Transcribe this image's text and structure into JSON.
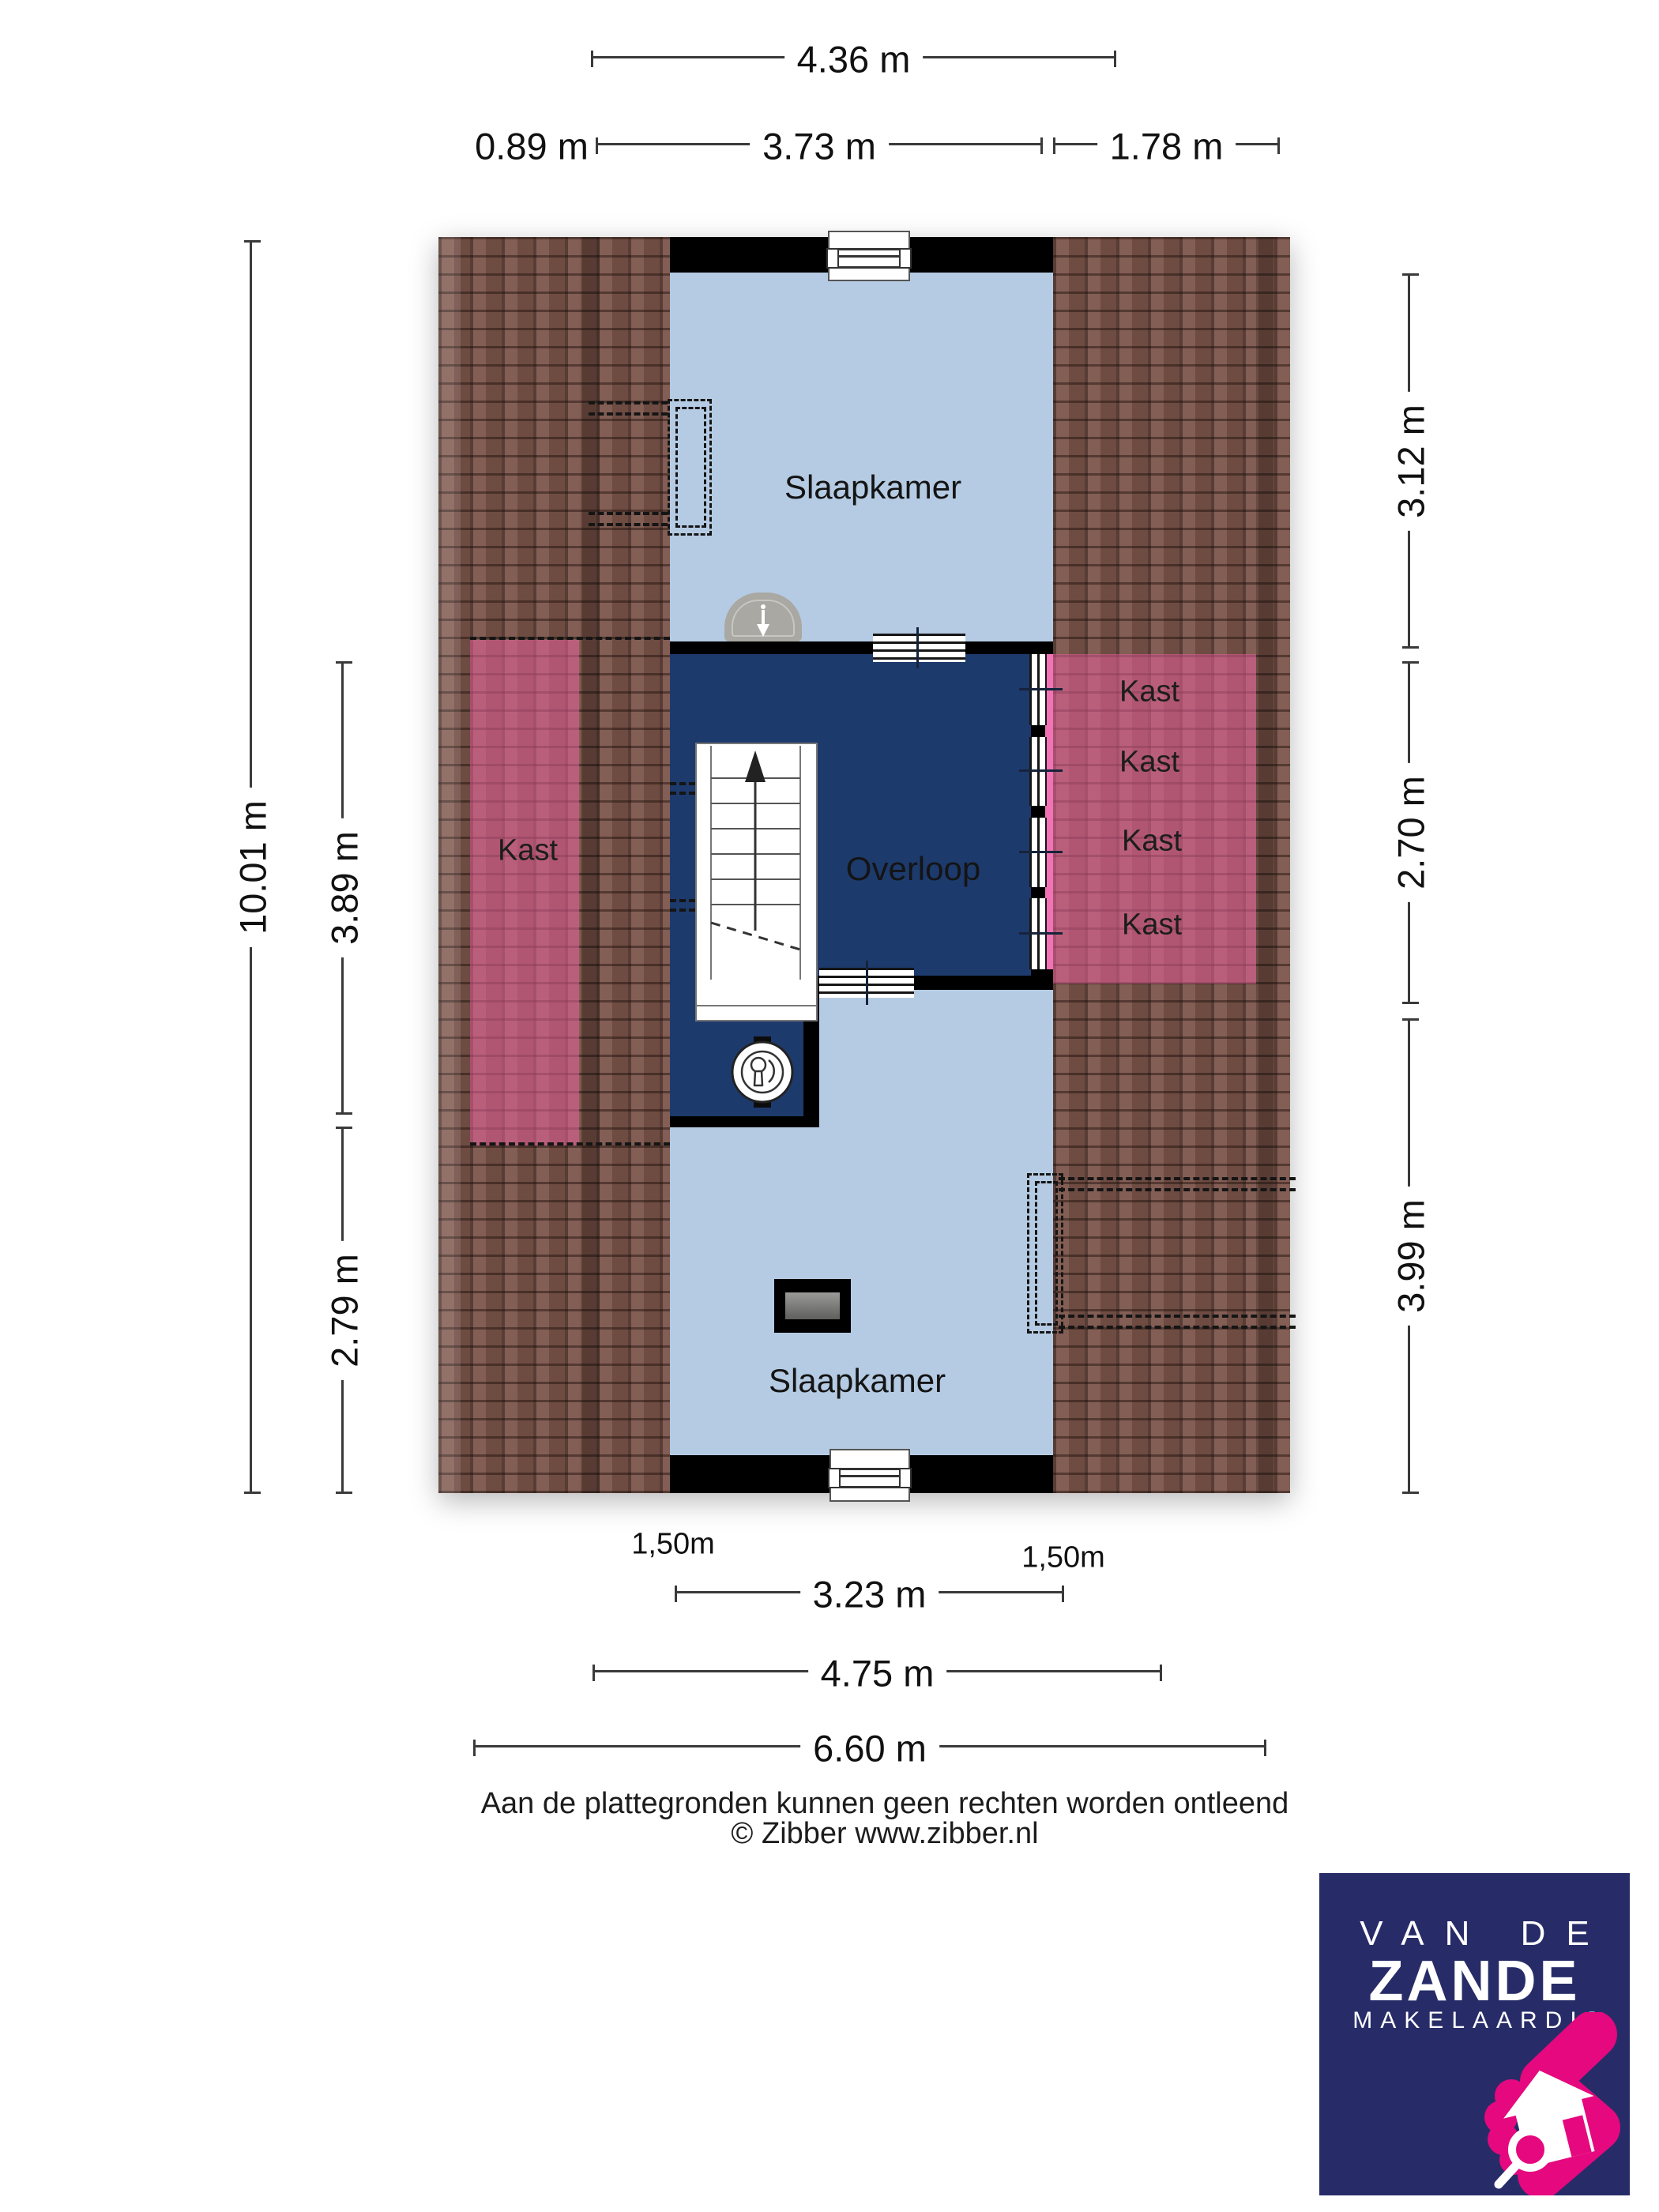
{
  "rooms": {
    "bedroom_top": "Slaapkamer",
    "landing": "Overloop",
    "bedroom_bottom": "Slaapkamer",
    "closet_left": "Kast",
    "closets_right": [
      "Kast",
      "Kast",
      "Kast",
      "Kast"
    ]
  },
  "dimensions": {
    "top_total": "4.36 m",
    "top_segments": [
      "0.89 m",
      "3.73 m",
      "1.78 m"
    ],
    "left_total": "10.01 m",
    "left_segments": [
      "3.89 m",
      "2.79 m"
    ],
    "right_segments": [
      "3.12 m",
      "2.70 m",
      "3.99 m"
    ],
    "bottom_segments": [
      "3.23 m",
      "4.75 m",
      "6.60 m"
    ],
    "headroom_labels": [
      "1,50m",
      "1,50m"
    ]
  },
  "footer": {
    "line1": "Aan de plattegronden kunnen geen rechten worden ontleend",
    "line2": "© Zibber www.zibber.nl"
  },
  "logo": {
    "line1": "VAN DE",
    "line2": "ZANDE",
    "line3": "MAKELAARDIJ"
  },
  "colors": {
    "room-light": "#b5cbe3",
    "room-dark": "#1d3a6c",
    "wall": "#000000",
    "roof-base": "#7b544a",
    "pink-overlay": "#e7609a",
    "pink-strip": "#f173b5",
    "dim-line": "#3a3a3a",
    "logo-bg": "#272c68",
    "logo-pink": "#e5087e"
  }
}
